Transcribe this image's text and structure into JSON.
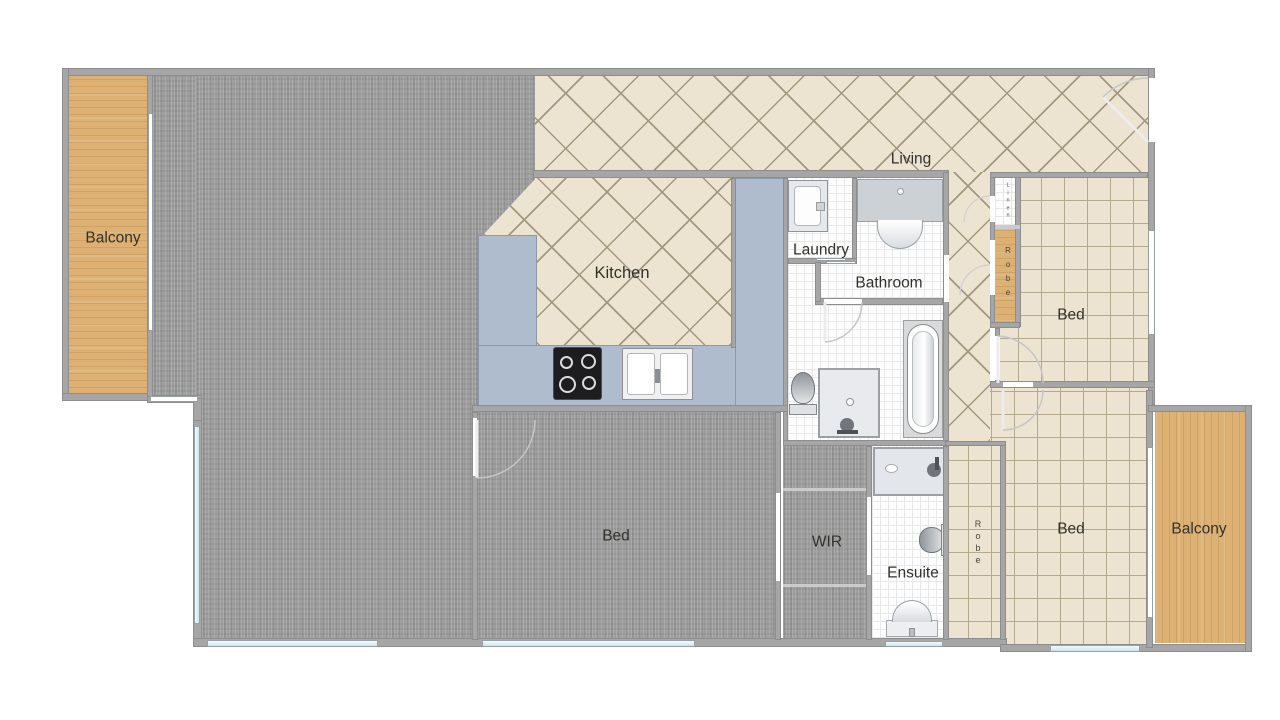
{
  "labels": {
    "balcony_left": "Balcony",
    "living": "Living",
    "kitchen": "Kitchen",
    "laundry": "Laundry",
    "bathroom": "Bathroom",
    "bed_top": "Bed",
    "bed_middle": "Bed",
    "bed_bottom": "Bed",
    "wir": "WIR",
    "ensuite": "Ensuite",
    "robe_top": "Robe",
    "robe_bottom": "Robe",
    "linen": "Linen",
    "balcony_right": "Balcony"
  },
  "colors": {
    "wall": "#a6a6a6",
    "carpet": "#9e9e9e",
    "tile_floor": "#ece4d0",
    "tile_grout": "#a2987f",
    "grid_line": "#b3a98f",
    "counter": "#aebccd",
    "wood": "#dcb173",
    "white_floor": "#fefefe",
    "window_blue": "#cfe4ee",
    "label_text": "#33312c"
  }
}
